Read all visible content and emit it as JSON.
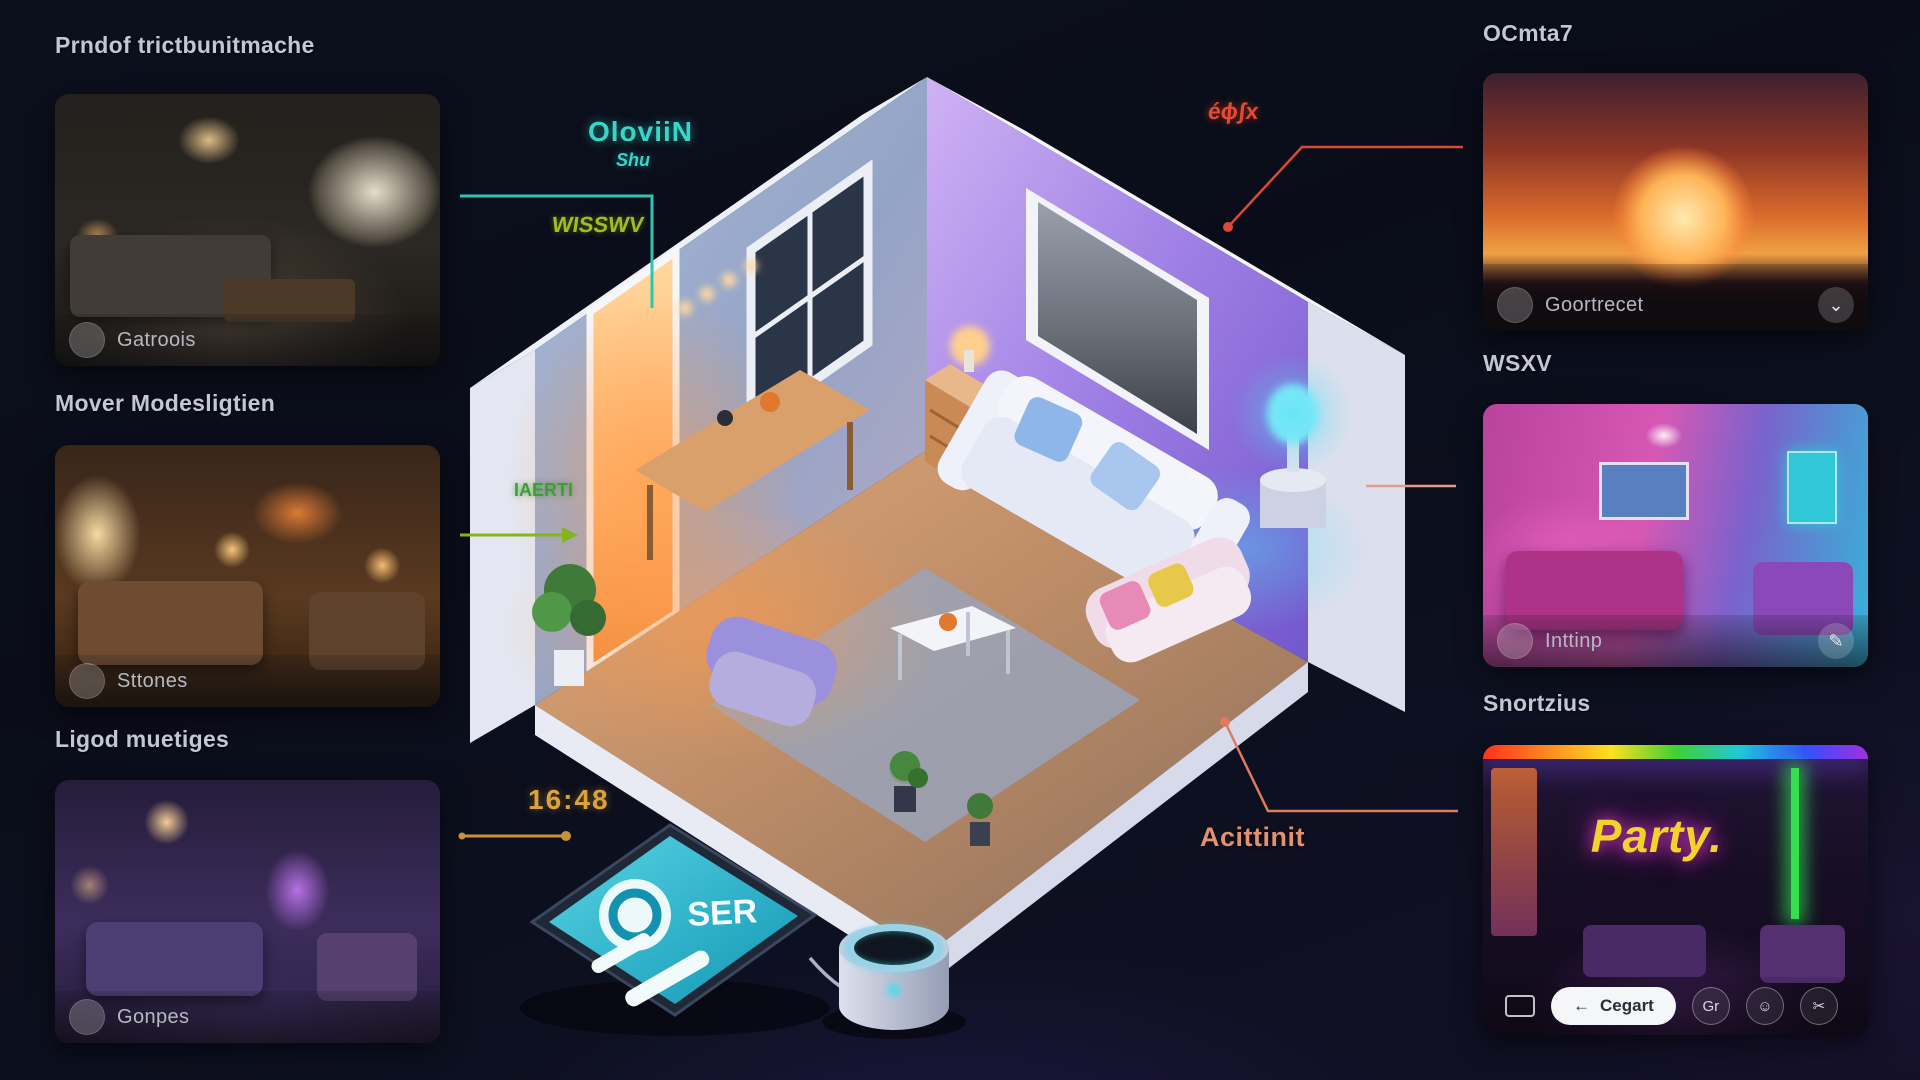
{
  "left_panels": [
    {
      "title": "Prndof trictbunitmache",
      "caption": "Gatroois"
    },
    {
      "title": "Mover Modesligtien",
      "caption": "Sttones"
    },
    {
      "title": "Ligod muetiges",
      "caption": "Gonpes"
    }
  ],
  "right_panels": [
    {
      "title": "OCmta7",
      "caption": "Goortrecet",
      "action_icon": "⌄"
    },
    {
      "title": "WSXV",
      "caption": "Inttinp",
      "action_icon": "✎"
    },
    {
      "title": "Snortzius",
      "neon_text": "Party.",
      "toolbar": {
        "pill_arrow": "←",
        "pill_label": "Cegart",
        "btn1": "Gr",
        "btn2": "☺",
        "btn3": "✂"
      }
    }
  ],
  "annotations": {
    "cyan_label": "OloviiN",
    "cyan_sub": "Shu",
    "lime_label": "WISSWV",
    "green_label": "IAERTI",
    "time_label": "16:48",
    "red_label": "éϕʃx",
    "orange_label": "Acittinit"
  },
  "tablet": {
    "screen_text": "SER"
  },
  "colors": {
    "cyan": "#35d8c8",
    "lime": "#a2bc20",
    "green": "#3f9e35",
    "amber": "#dca23c",
    "red": "#e54a30",
    "orange": "#e39070"
  }
}
